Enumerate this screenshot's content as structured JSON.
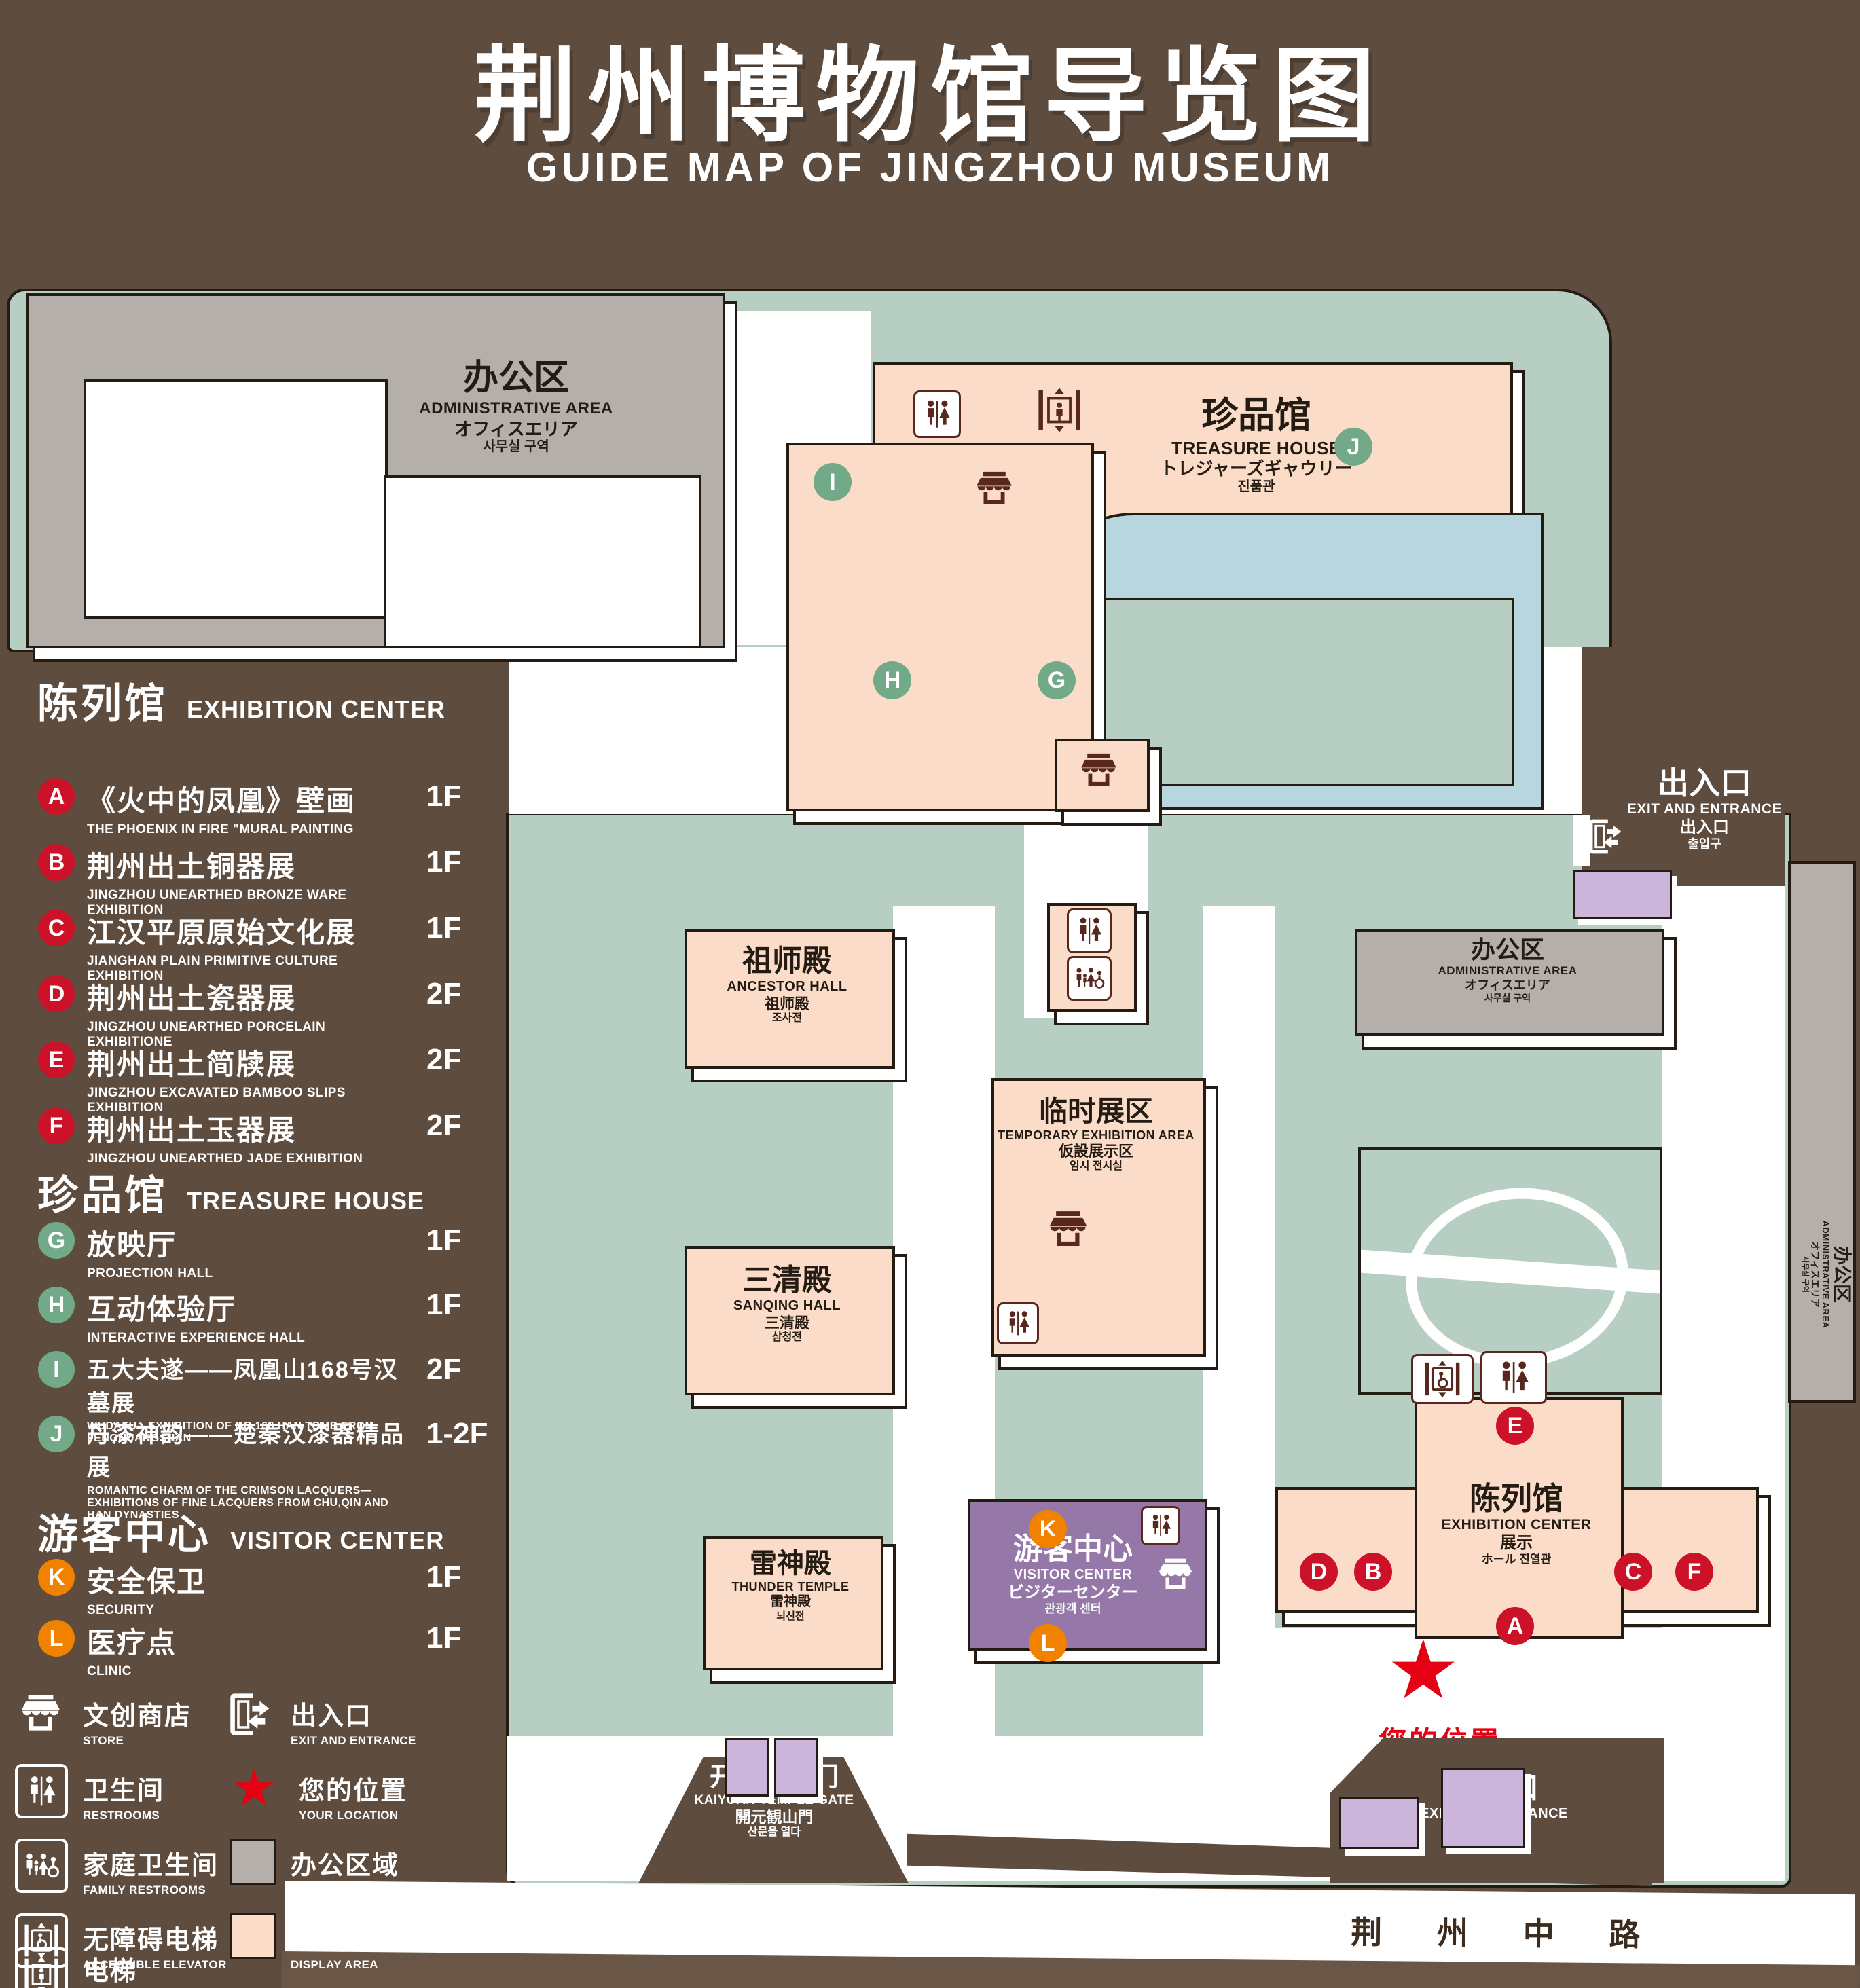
{
  "title": {
    "zh": "荆州博物馆导览图",
    "en": "GUIDE MAP OF JINGZHOU MUSEUM"
  },
  "legend": {
    "sections": {
      "exhibition_center": {
        "zh": "陈列馆",
        "en": "EXHIBITION CENTER"
      },
      "treasure_house": {
        "zh": "珍品馆",
        "en": "TREASURE HOUSE"
      },
      "visitor_center": {
        "zh": "游客中心",
        "en": "VISITOR CENTER"
      }
    },
    "items": {
      "A": {
        "letter": "A",
        "zh": "《火中的凤凰》壁画",
        "en": "THE PHOENIX IN FIRE \"MURAL PAINTING",
        "floor": "1F"
      },
      "B": {
        "letter": "B",
        "zh": "荆州出土铜器展",
        "en": "JINGZHOU UNEARTHED BRONZE WARE EXHIBITION",
        "floor": "1F"
      },
      "C": {
        "letter": "C",
        "zh": "江汉平原原始文化展",
        "en": "JIANGHAN PLAIN PRIMITIVE CULTURE EXHIBITION",
        "floor": "1F"
      },
      "D": {
        "letter": "D",
        "zh": "荆州出土瓷器展",
        "en": "JINGZHOU UNEARTHED PORCELAIN EXHIBITIONE",
        "floor": "2F"
      },
      "E": {
        "letter": "E",
        "zh": "荆州出土简牍展",
        "en": "JINGZHOU EXCAVATED BAMBOO SLIPS EXHIBITION",
        "floor": "2F"
      },
      "F": {
        "letter": "F",
        "zh": "荆州出土玉器展",
        "en": "JINGZHOU UNEARTHED JADE EXHIBITION",
        "floor": "2F"
      },
      "G": {
        "letter": "G",
        "zh": "放映厅",
        "en": "PROJECTION HALL",
        "floor": "1F"
      },
      "H": {
        "letter": "H",
        "zh": "互动体验厅",
        "en": "INTERACTIVE EXPERIENCE HALL",
        "floor": "1F"
      },
      "I": {
        "letter": "I",
        "zh": "五大夫遂——凤凰山168号汉墓展",
        "en": "WUDAFU—EXHIBITION OF NO.168 HAN TOMB FROM FENGHUANGSHAN",
        "floor": "2F"
      },
      "J": {
        "letter": "J",
        "zh": "丹漆神韵——楚秦汉漆器精品展",
        "en": "ROMANTIC CHARM OF THE CRIMSON LACQUERS—EXHIBITIONS OF FINE LACQUERS FROM CHU,QIN AND HAN DYNASTIES",
        "floor": "1-2F"
      },
      "K": {
        "letter": "K",
        "zh": "安全保卫",
        "en": "SECURITY",
        "floor": "1F"
      },
      "L": {
        "letter": "L",
        "zh": "医疗点",
        "en": "CLINIC",
        "floor": "1F"
      }
    },
    "symbols": {
      "store": {
        "zh": "文创商店",
        "en": "STORE"
      },
      "exit": {
        "zh": "出入口",
        "en": "EXIT AND ENTRANCE"
      },
      "restroom": {
        "zh": "卫生间",
        "en": "RESTROOMS"
      },
      "location": {
        "zh": "您的位置",
        "en": "YOUR LOCATION"
      },
      "family": {
        "zh": "家庭卫生间",
        "en": "FAMILY RESTROOMS"
      },
      "office": {
        "zh": "办公区域",
        "en": "OFFICE AREA"
      },
      "accessible": {
        "zh": "无障碍电梯",
        "en": "ACCESSIBLE ELEVATOR"
      },
      "display": {
        "zh": "展示区域",
        "en": "DISPLAY AREA"
      },
      "elevator": {
        "zh": "电梯",
        "en": "Elevator"
      }
    }
  },
  "map": {
    "admin": {
      "zh": "办公区",
      "en": "ADMINISTRATIVE AREA",
      "ja": "オフィスエリア",
      "ko": "사무실 구역"
    },
    "treasure_house": {
      "zh": "珍品馆",
      "en": "TREASURE HOUSE",
      "ja": "トレジャーズギャウリー",
      "ko": "진품관"
    },
    "ancestor_hall": {
      "zh": "祖师殿",
      "en": "ANCESTOR HALL",
      "ja": "祖师殿",
      "ko": "조사전"
    },
    "temporary_exhibition": {
      "zh": "临时展区",
      "en": "TEMPORARY EXHIBITION AREA",
      "ja": "仮設展示区",
      "ko": "임시 전시실"
    },
    "sanqing_hall": {
      "zh": "三清殿",
      "en": "SANQING HALL",
      "ja": "三清殿",
      "ko": "삼청전"
    },
    "thunder_temple": {
      "zh": "雷神殿",
      "en": "THUNDER TEMPLE",
      "ja": "雷神殿",
      "ko": "뇌신전"
    },
    "visitor_center": {
      "zh": "游客中心",
      "en": "VISITOR CENTER",
      "ja": "ビジターセンター",
      "ko": "관광객 센터"
    },
    "exhibition_center": {
      "zh": "陈列馆",
      "en": "EXHIBITION CENTER",
      "ja": "展示",
      "ko": "ホール 진열관"
    },
    "kaiyuan_gate": {
      "zh": "开元观山门",
      "en": "KAIYUAN TEMPLE GATE",
      "ja": "開元観山門",
      "ko": "산문을 열다"
    },
    "exit": {
      "zh": "出入口",
      "en": "EXIT AND ENTRANCE",
      "ja": "出入口",
      "ko": "출입구"
    },
    "your_location": "您的位置",
    "road": "荆 州 中 路",
    "markers": {
      "A": "A",
      "B": "B",
      "C": "C",
      "D": "D",
      "E": "E",
      "F": "F",
      "G": "G",
      "H": "H",
      "I": "I",
      "J": "J",
      "K": "K",
      "L": "L"
    }
  },
  "icons": {
    "star": "★"
  },
  "colors": {
    "background": "#5e4c3f",
    "grass": "#b7cfc2",
    "display_area": "#fadcc8",
    "office_area": "#b5afab",
    "visitor_center": "#9577a8",
    "gate_booth": "#cbb5da",
    "pond": "#b7d6e0",
    "badge_red": "#cb1228",
    "badge_green": "#72a989",
    "badge_orange": "#f08200",
    "location_red": "#e60013",
    "icon_maroon": "#58281e",
    "outline": "#241b12"
  }
}
